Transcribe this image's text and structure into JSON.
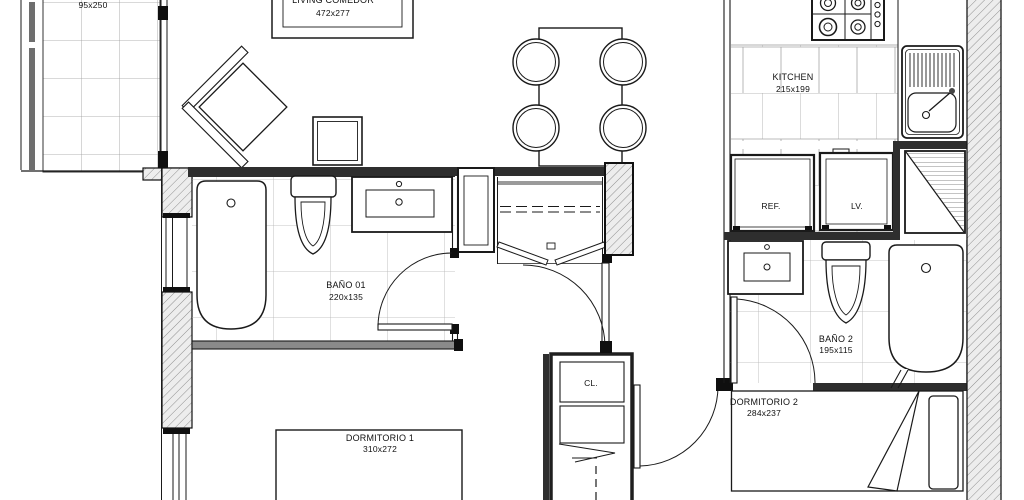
{
  "plan_title": "apartment floor plan",
  "rooms": {
    "living": {
      "name": "LIVING COMEDOR",
      "dims": "472x277"
    },
    "balcony": {
      "dims": "95x250"
    },
    "kitchen": {
      "name": "KITCHEN",
      "dims": "215x199"
    },
    "bath1": {
      "name": "BAÑO 01",
      "dims": "220x135"
    },
    "bath2": {
      "name": "BAÑO 2",
      "dims": "195x115"
    },
    "bedroom1": {
      "name": "DORMITORIO 1",
      "dims": "310x272"
    },
    "bedroom2": {
      "name": "DORMITORIO 2",
      "dims": "284x237"
    },
    "closet": {
      "name": "CL."
    }
  },
  "appliances": {
    "fridge": "REF.",
    "washer": "LV."
  },
  "colors": {
    "line": "#1a1a1a",
    "wall": "#2e2e2e",
    "tile_grid": "#b3b3b3",
    "hatch_bg": "#ededed"
  }
}
